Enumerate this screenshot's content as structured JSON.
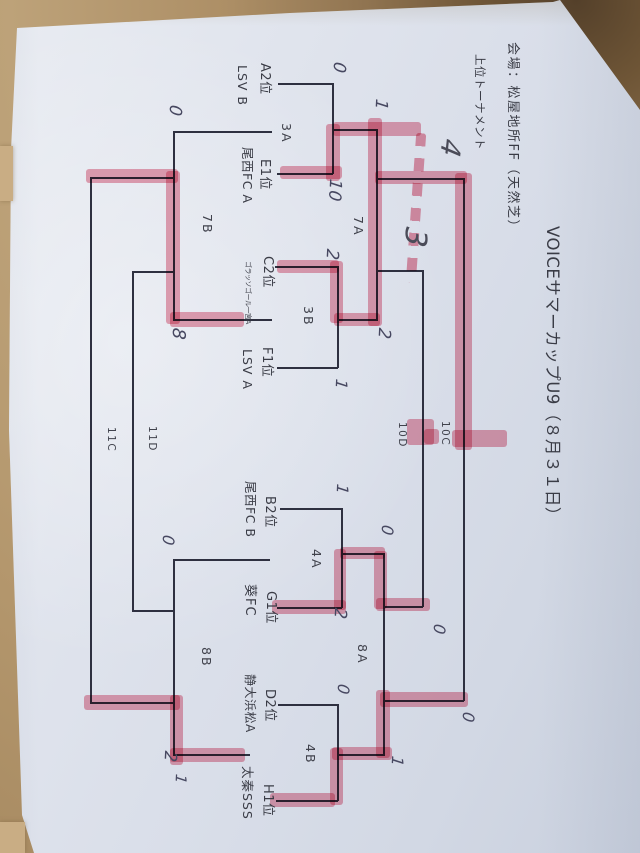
{
  "tournament": {
    "title": "VOICEサマーカップU9（８月３１日）",
    "venue": "会場：松屋地所FF（天然芝）",
    "bracket_name": "上位トーナメント"
  },
  "teams": {
    "a2": {
      "seed": "A2位",
      "name": "LSV B"
    },
    "e1": {
      "seed": "E1位",
      "name": "尾西FC A"
    },
    "c2": {
      "seed": "C2位",
      "name": "ゴラッソゴール一宮A"
    },
    "f1": {
      "seed": "F1位",
      "name": "LSV A"
    },
    "b2": {
      "seed": "B2位",
      "name": "尾西FC B"
    },
    "g1": {
      "seed": "G1位",
      "name": "葵FC"
    },
    "d2": {
      "seed": "D2位",
      "name": "静大浜松A"
    },
    "h1": {
      "seed": "H1位",
      "name": "太秦SSS"
    }
  },
  "matches": {
    "m3a": {
      "label": "3A",
      "score_top": "0",
      "score_bottom": "10"
    },
    "m3b": {
      "label": "3B",
      "score_top": "2",
      "score_bottom": "1"
    },
    "m7a": {
      "label": "7A",
      "score_top": "1",
      "score_bottom": "2"
    },
    "m7b": {
      "label": "7B",
      "score_top": "0",
      "score_bottom": "8"
    },
    "m4a": {
      "label": "4A",
      "score_top": "1",
      "score_bottom": "2"
    },
    "m4b": {
      "label": "4B",
      "score_top": "0",
      "score_bottom": "1"
    },
    "m8a": {
      "label": "8A",
      "score_top": "0",
      "score_bottom": "1"
    },
    "m8b": {
      "label": "8B",
      "score_top": "0",
      "score_bottom": "2"
    },
    "m10c": {
      "label": "10C",
      "score_top": "4",
      "score_bottom": "0"
    },
    "m10d": {
      "label": "10D",
      "score_top": "3",
      "score_bottom": "0"
    },
    "m11c": {
      "label": "11C"
    },
    "m11d": {
      "label": "11D"
    }
  },
  "annotations": {
    "extra_mark": "1"
  },
  "colors": {
    "highlighter": "#de5573",
    "pen": "#2e3040",
    "paper": "#dde2ec",
    "table": "#ad8f66"
  }
}
